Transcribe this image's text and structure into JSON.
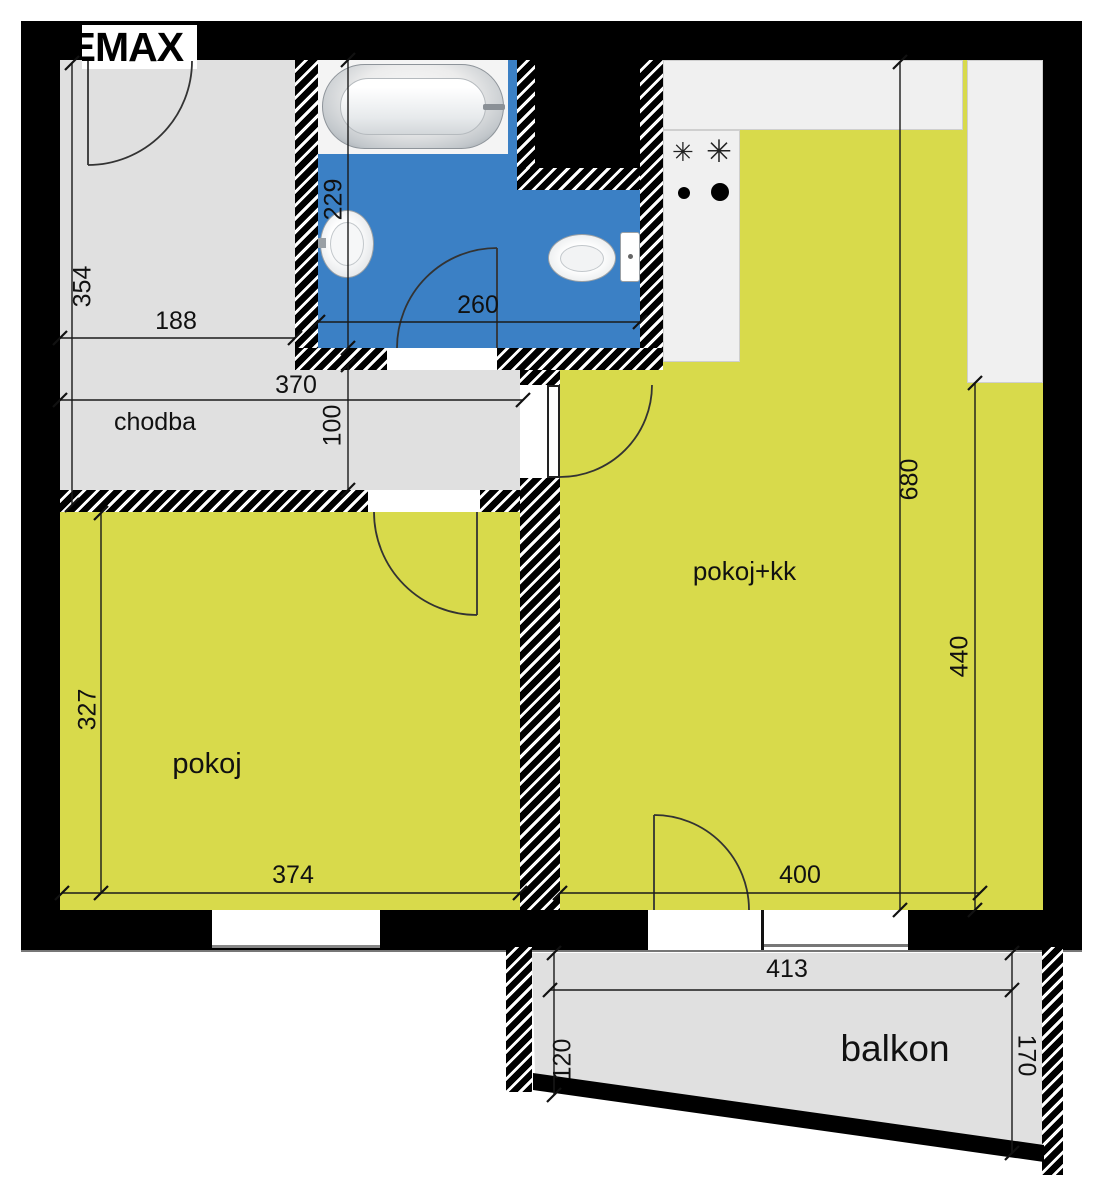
{
  "logo": {
    "partial": "E/",
    "visible": "MAX"
  },
  "rooms": {
    "chodba": "chodba",
    "pokoj": "pokoj",
    "pokoj_kk": "pokoj+kk",
    "balkon": "balkon"
  },
  "dimensions": {
    "d354": "354",
    "d188": "188",
    "d370": "370",
    "d100": "100",
    "d229": "229",
    "d260": "260",
    "d327": "327",
    "d374": "374",
    "d680": "680",
    "d440": "440",
    "d400": "400",
    "d413": "413",
    "d120": "120",
    "d170": "170"
  },
  "icons": {
    "burner_star": "✳"
  },
  "colors": {
    "wall_black": "#000000",
    "floor_gray": "#e0e0e0",
    "room_yellow": "#d8da4b",
    "bath_blue": "#3b80c5",
    "counter_white": "#f0f0f0"
  }
}
